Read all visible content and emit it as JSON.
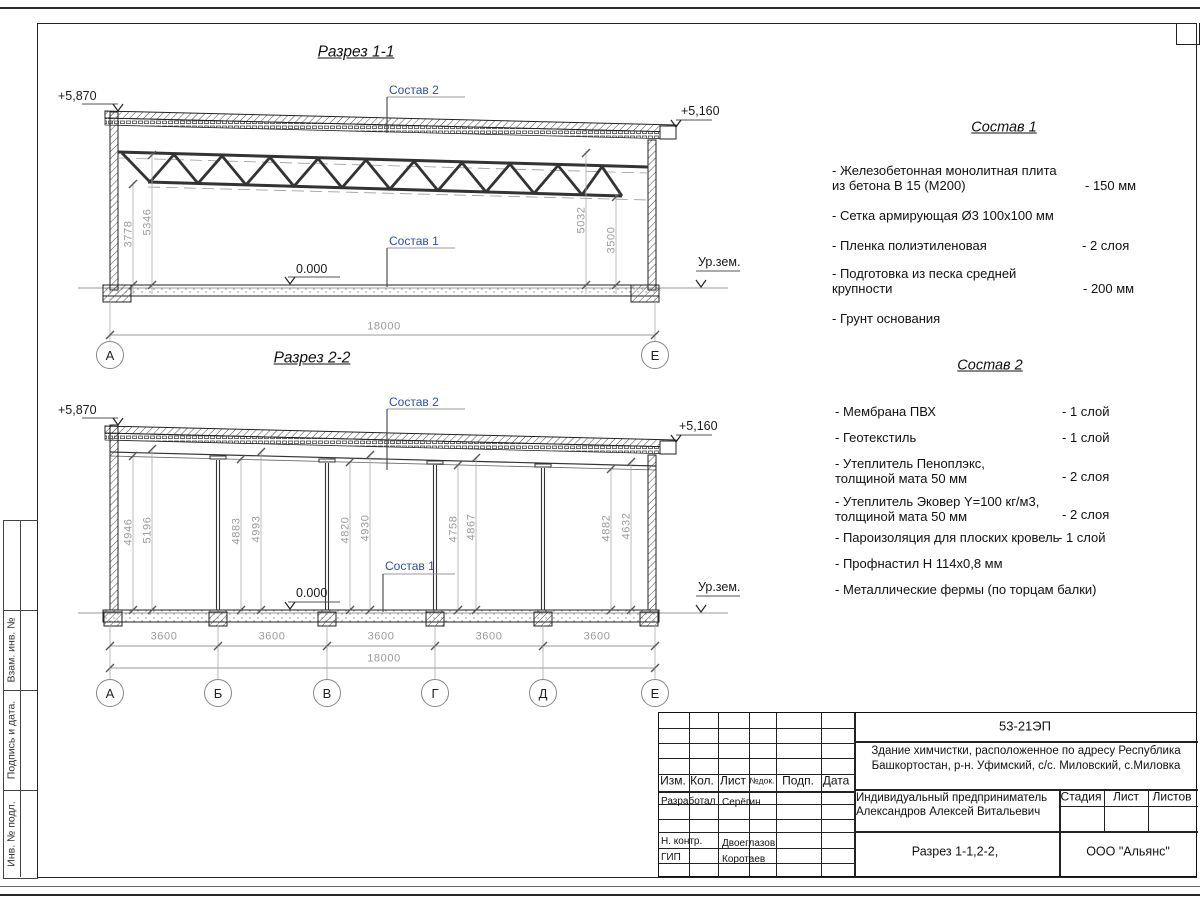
{
  "page": {
    "section1": {
      "title": "Разрез 1-1",
      "elev_left": "+5,870",
      "elev_right": "+5,160",
      "zero": "0.000",
      "ground": "Ур.зем.",
      "callout_roof": "Состав 2",
      "callout_floor": "Состав 1",
      "dim_left_inner": "3778",
      "dim_left_outer": "5346",
      "dim_right_inner": "5032",
      "dim_right_outer": "3500",
      "dim_total": "18000",
      "axis_a": "А",
      "axis_e": "Е"
    },
    "section2": {
      "title": "Разрез 2-2",
      "elev_left": "+5,870",
      "elev_right": "+5,160",
      "zero": "0.000",
      "ground": "Ур.зем.",
      "callout_roof": "Состав 2",
      "callout_floor": "Состав 1",
      "pairs": [
        [
          "4946",
          "5196"
        ],
        [
          "4883",
          "4993"
        ],
        [
          "4820",
          "4930"
        ],
        [
          "4758",
          "4867"
        ],
        [
          "4882",
          "4632"
        ]
      ],
      "bays": [
        "3600",
        "3600",
        "3600",
        "3600",
        "3600"
      ],
      "dim_total": "18000",
      "axes": [
        "А",
        "Б",
        "В",
        "Г",
        "Д",
        "Е"
      ]
    },
    "sostav1": {
      "title": "Состав 1",
      "items": [
        {
          "name": "- Железобетонная  монолитная плита\n  из бетона В 15 (М200)",
          "value": "- 150 мм"
        },
        {
          "name": "- Сетка армирующая Ø3 100х100 мм",
          "value": ""
        },
        {
          "name": "- Пленка полиэтиленовая",
          "value": "-  2 слоя"
        },
        {
          "name": "- Подготовка из песка средней\n  крупности",
          "value": "- 200 мм"
        },
        {
          "name": "- Грунт основания",
          "value": ""
        }
      ]
    },
    "sostav2": {
      "title": "Состав 2",
      "items": [
        {
          "name": "- Мембрана ПВХ",
          "value": "- 1 слой"
        },
        {
          "name": "- Геотекстиль",
          "value": "- 1 слой"
        },
        {
          "name": "- Утеплитель Пеноплэкс,\n  толщиной мата 50 мм",
          "value": "- 2 слоя"
        },
        {
          "name": "- Утеплитель Эковер Y=100 кг/м3,\n  толщиной мата 50 мм",
          "value": "- 2 слоя"
        },
        {
          "name": "- Пароизоляция для плоских кровель",
          "value": "- 1 слой"
        },
        {
          "name": "- Профнастил Н 114х0,8 мм",
          "value": ""
        },
        {
          "name": "- Металлические фермы (по торцам балки)",
          "value": ""
        }
      ]
    },
    "titleblock": {
      "doc_number": "53-21ЭП",
      "object": "Здание химчистки,  расположенное по адресу Республика\nБашкортостан, р-н. Уфимский, с/с. Миловский, с.Миловка",
      "cols": [
        "Изм.",
        "Кол.",
        "Лист",
        "№док.",
        "Подп.",
        "Дата"
      ],
      "role_rows": [
        {
          "role": "Разработал",
          "name": "Серёгин"
        },
        {
          "role": "Н. контр.",
          "name": "Двоеглазов"
        },
        {
          "role": "ГИП",
          "name": "Коротаев"
        }
      ],
      "client": "Индивидуальный предприниматель\nАлександров Алексей Витальевич",
      "stage_cols": [
        "Стадия",
        "Лист",
        "Листов"
      ],
      "sheet_title": "Разрез 1-1,2-2,",
      "company": "ООО \"Альянс\""
    },
    "side_strip": [
      "Взам. инв. №",
      "Подпись  и  дата.",
      "Инв. № подл."
    ]
  }
}
